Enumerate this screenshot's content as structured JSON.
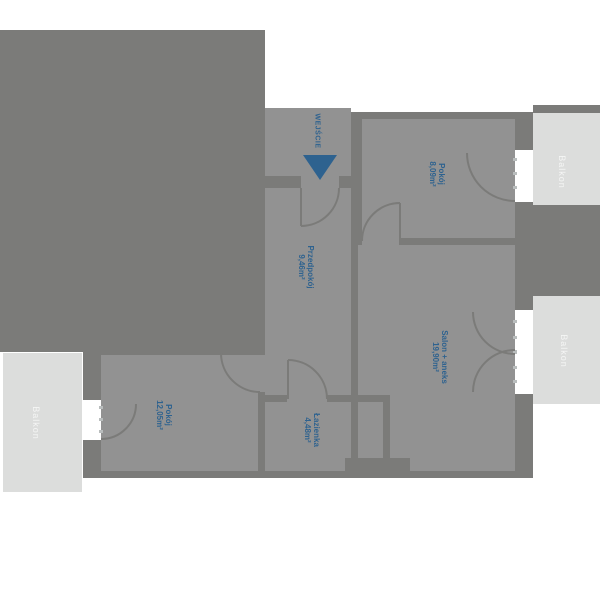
{
  "entrance": {
    "label": "WEJŚCIE"
  },
  "rooms": [
    {
      "id": "pokoj-1",
      "name": "Pokój",
      "area": "8,09m²"
    },
    {
      "id": "salon",
      "name": "Salon + aneks",
      "area": "19,90m²"
    },
    {
      "id": "przedpokoj",
      "name": "Przedpokój",
      "area": "9,46m²"
    },
    {
      "id": "lazienka",
      "name": "Łazienka",
      "area": "4,48m²"
    },
    {
      "id": "pokoj-2",
      "name": "Pokój",
      "area": "12,05m²"
    }
  ],
  "balconies": [
    {
      "label": "Balkon"
    },
    {
      "label": "Balkon"
    },
    {
      "label": "Balkon"
    }
  ],
  "colors": {
    "wall": "#7b7b79",
    "floor": "#929292",
    "balcony": "#dcdddc",
    "accent": "#2e628f",
    "window": "#ffffff"
  }
}
